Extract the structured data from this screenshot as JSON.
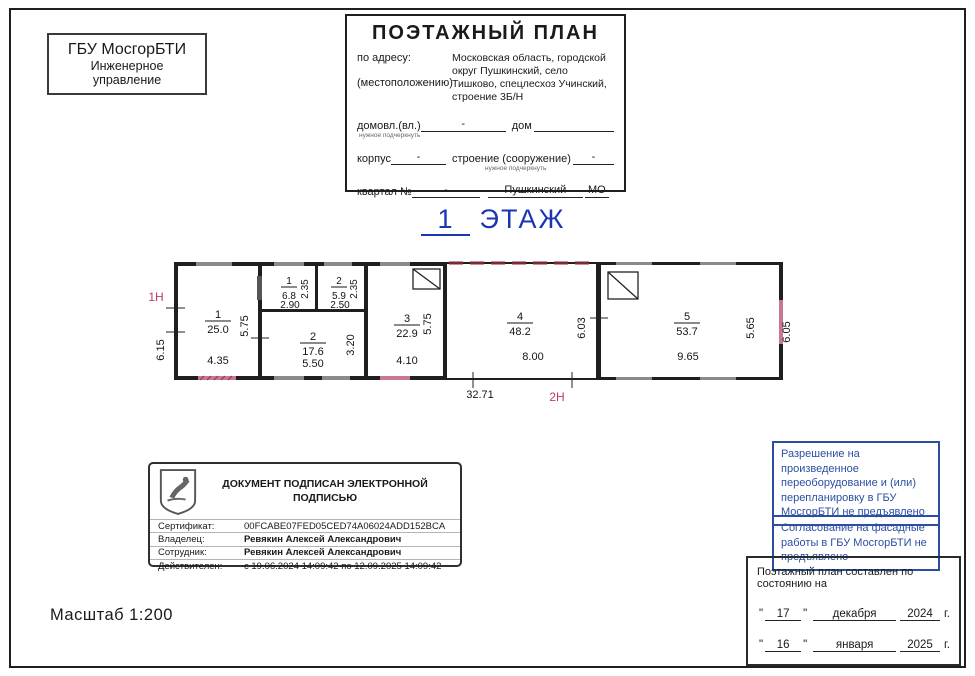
{
  "org_box": {
    "line1": "ГБУ МосгорБТИ",
    "line2": "Инженерное",
    "line3": "управление"
  },
  "header": {
    "title": "ПОЭТАЖНЫЙ ПЛАН",
    "address_label_1": "по адресу:",
    "address_label_2": "(местоположению)",
    "address_value": "Московская область, городской округ Пушкинский, село Тишково, спецлесхоз Учинский, строение 3Б/Н",
    "note_small": "нужное подчеркнуть",
    "row1": {
      "label1": "домовл.(вл.)",
      "value1": "-",
      "label2": "дом"
    },
    "row2": {
      "label1": "корпус",
      "value1": "-",
      "label2": "строение (сооружение)",
      "value2": "-"
    },
    "row3": {
      "label1": "квартал №",
      "value1": "-",
      "value2": "Пушкинский",
      "suffix": "МО"
    }
  },
  "floor_title": {
    "number": "1",
    "label": "ЭТАЖ"
  },
  "plan": {
    "label_left": "1Н",
    "label_bottom": "2Н",
    "overall_width": "32.71",
    "outer_height_left": "6.15",
    "rooms": {
      "r1": {
        "num": "1",
        "area": "25.0",
        "width": "4.35",
        "height": "5.75"
      },
      "r1a": {
        "num": "1",
        "area": "6.8",
        "width": "2.90",
        "height": "2.35"
      },
      "r2a": {
        "num": "2",
        "area": "5.9",
        "width": "2.50",
        "height": "2.35"
      },
      "r2": {
        "num": "2",
        "area": "17.6",
        "width": "5.50",
        "height": "3.20"
      },
      "r3": {
        "num": "3",
        "area": "22.9",
        "width": "4.10",
        "height": "5.75"
      },
      "r4": {
        "num": "4",
        "area": "48.2",
        "width": "8.00",
        "height": "6.03"
      },
      "r5": {
        "num": "5",
        "area": "53.7",
        "width": "9.65",
        "height": "5.65",
        "outer_height": "6.05"
      }
    }
  },
  "stamp": {
    "title": "ДОКУМЕНТ ПОДПИСАН ЭЛЕКТРОННОЙ ПОДПИСЬЮ",
    "rows": [
      {
        "label": "Сертификат:",
        "value": "00FCABE07FED05CED74A06024ADD152BCA"
      },
      {
        "label": "Владелец:",
        "value": "Ревякин Алексей Александрович"
      },
      {
        "label": "Сотрудник:",
        "value": "Ревякин Алексей Александрович"
      },
      {
        "label": "Действителен:",
        "value": "с 19.06.2024 14:09:42 по 12.09.2025 14:09:42"
      }
    ]
  },
  "notes": {
    "note1": "Разрешение на произведенное переоборудование и (или) перепланировку в ГБУ МосгорБТИ не предъявлено",
    "note2": "Согласование на фасадные работы в ГБУ МосгорБТИ не предъявлено"
  },
  "date_box": {
    "title": "Поэтажный план составлен по состоянию на",
    "dates": [
      {
        "day": "17",
        "month": "декабря",
        "year": "2024",
        "suffix": "г."
      },
      {
        "day": "16",
        "month": "января",
        "year": "2025",
        "suffix": "г."
      }
    ]
  },
  "scale_label": "Масштаб 1:200",
  "colors": {
    "accent_blue": "#2b4ea2",
    "title_blue": "#1b35b5",
    "mark_red": "#c23b5e",
    "door_pink": "#c9798f",
    "window_gray": "#8a8a8a"
  }
}
